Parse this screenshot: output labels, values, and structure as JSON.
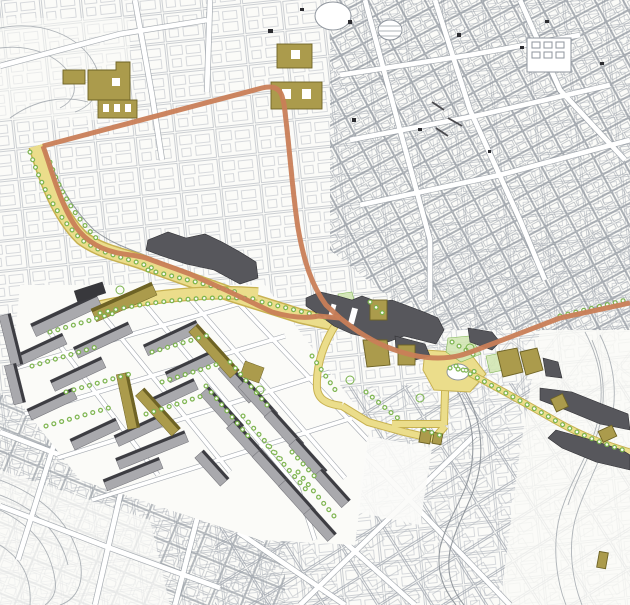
{
  "window": {
    "width": 630,
    "height": 605
  },
  "colors": {
    "paper": "#fbfbf8",
    "line_light": "#abb0b8",
    "line_mid": "#8f959d",
    "route_orange": "#c97e57",
    "street_yellow": "#ebdd8b",
    "street_yellow_edge": "#c8b251",
    "block_khaki": "#ab9b4c",
    "block_khaki_edge": "#6e6325",
    "building_dark": "#57575c",
    "slab_gray": "#a9a9ad",
    "slab_edge": "#3d3d42",
    "tree_green": "#79b24a",
    "green_patch": "#d3e7b4",
    "water_gray": "#8b9096"
  },
  "map": {
    "type": "urban-plan",
    "layers": [
      {
        "id": "cadastral-base",
        "icon": "linework-texture",
        "color": "#abb0b8"
      },
      {
        "id": "primary-route",
        "icon": "route-line",
        "color": "#c97e57"
      },
      {
        "id": "street-network",
        "icon": "surfaced-street",
        "color": "#ebdd8b"
      },
      {
        "id": "proposed-blocks",
        "icon": "khaki-building",
        "color": "#ab9b4c"
      },
      {
        "id": "key-buildings",
        "icon": "dark-building",
        "color": "#57575c"
      },
      {
        "id": "housing-slabs",
        "icon": "slab-building",
        "color": "#a9a9ad"
      },
      {
        "id": "vegetation",
        "icon": "tree-row",
        "color": "#79b24a"
      },
      {
        "id": "water",
        "icon": "river-line",
        "color": "#8b9096"
      }
    ]
  }
}
